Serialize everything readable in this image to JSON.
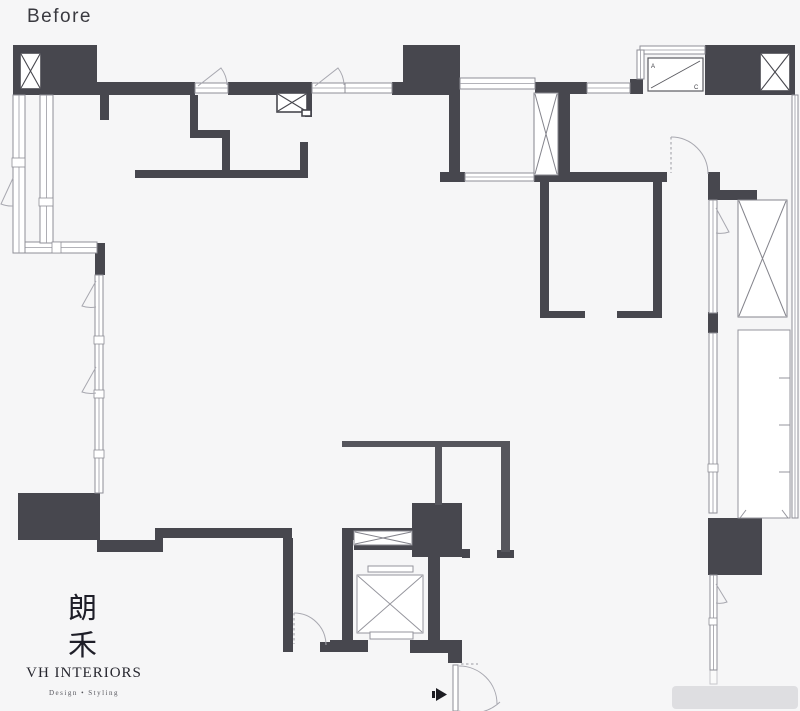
{
  "title": "Before",
  "floor_plan": {
    "type": "apartment-floor-plan-before-renovation",
    "ac_unit": {
      "label_a": "A",
      "label_c": "C"
    }
  },
  "logo": {
    "cjk_char_1": "朗",
    "cjk_char_2": "禾",
    "studio_name": "VH INTERIORS",
    "tagline": "Design • Styling"
  },
  "colors": {
    "wall": "#47474e",
    "thin_wall": "#55555c",
    "window_line": "#8f8f97",
    "swing_line": "#a8a8b0",
    "background": "#f6f6f7",
    "title_text": "#3a3a40",
    "logo_text": "#22222c",
    "watermark": "#dcdcde"
  }
}
